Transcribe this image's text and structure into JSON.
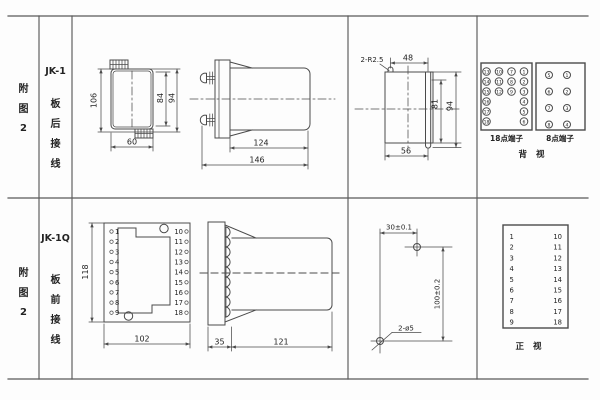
{
  "row1": {
    "col_figure": [
      "附",
      "图",
      "2"
    ],
    "col_model": [
      "JK-1",
      "板",
      "后",
      "接",
      "线"
    ],
    "rear_view": {
      "h106": "106",
      "w60": "60",
      "h84": "84",
      "h94": "94"
    },
    "side_view": {
      "d124": "124",
      "d146": "146"
    },
    "cutout": {
      "r": "2-R2.5",
      "w48": "48",
      "h81": "81",
      "h94": "94",
      "w56": "56"
    },
    "t18": {
      "label": "18点端子",
      "n": [
        "13",
        "10",
        "7",
        "1",
        "14",
        "11",
        "8",
        "2",
        "15",
        "12",
        "9",
        "3",
        "16",
        "4",
        "17",
        "5",
        "18",
        "6"
      ]
    },
    "t8": {
      "label": "8点端子",
      "n": [
        "5",
        "1",
        "6",
        "2",
        "7",
        "3",
        "8",
        "4"
      ]
    },
    "view": "背 视"
  },
  "row2": {
    "col_figure": [
      "附",
      "图",
      "2"
    ],
    "col_model": [
      "JK-1Q",
      "板",
      "前",
      "接",
      "线"
    ],
    "front_view": {
      "h118": "118",
      "w102": "102",
      "left": [
        "1",
        "2",
        "3",
        "4",
        "5",
        "6",
        "7",
        "8",
        "9"
      ],
      "right": [
        "10",
        "11",
        "12",
        "13",
        "14",
        "15",
        "16",
        "17",
        "18"
      ]
    },
    "side_view": {
      "d35": "35",
      "d121": "121"
    },
    "drill": {
      "w": "30±0.1",
      "h": "100±0.2",
      "label": "2-ø5"
    },
    "ttable": {
      "left": [
        "1",
        "2",
        "3",
        "4",
        "5",
        "6",
        "7",
        "8",
        "9"
      ],
      "right": [
        "10",
        "11",
        "12",
        "13",
        "14",
        "15",
        "16",
        "17",
        "18"
      ],
      "view": "正 视"
    }
  }
}
